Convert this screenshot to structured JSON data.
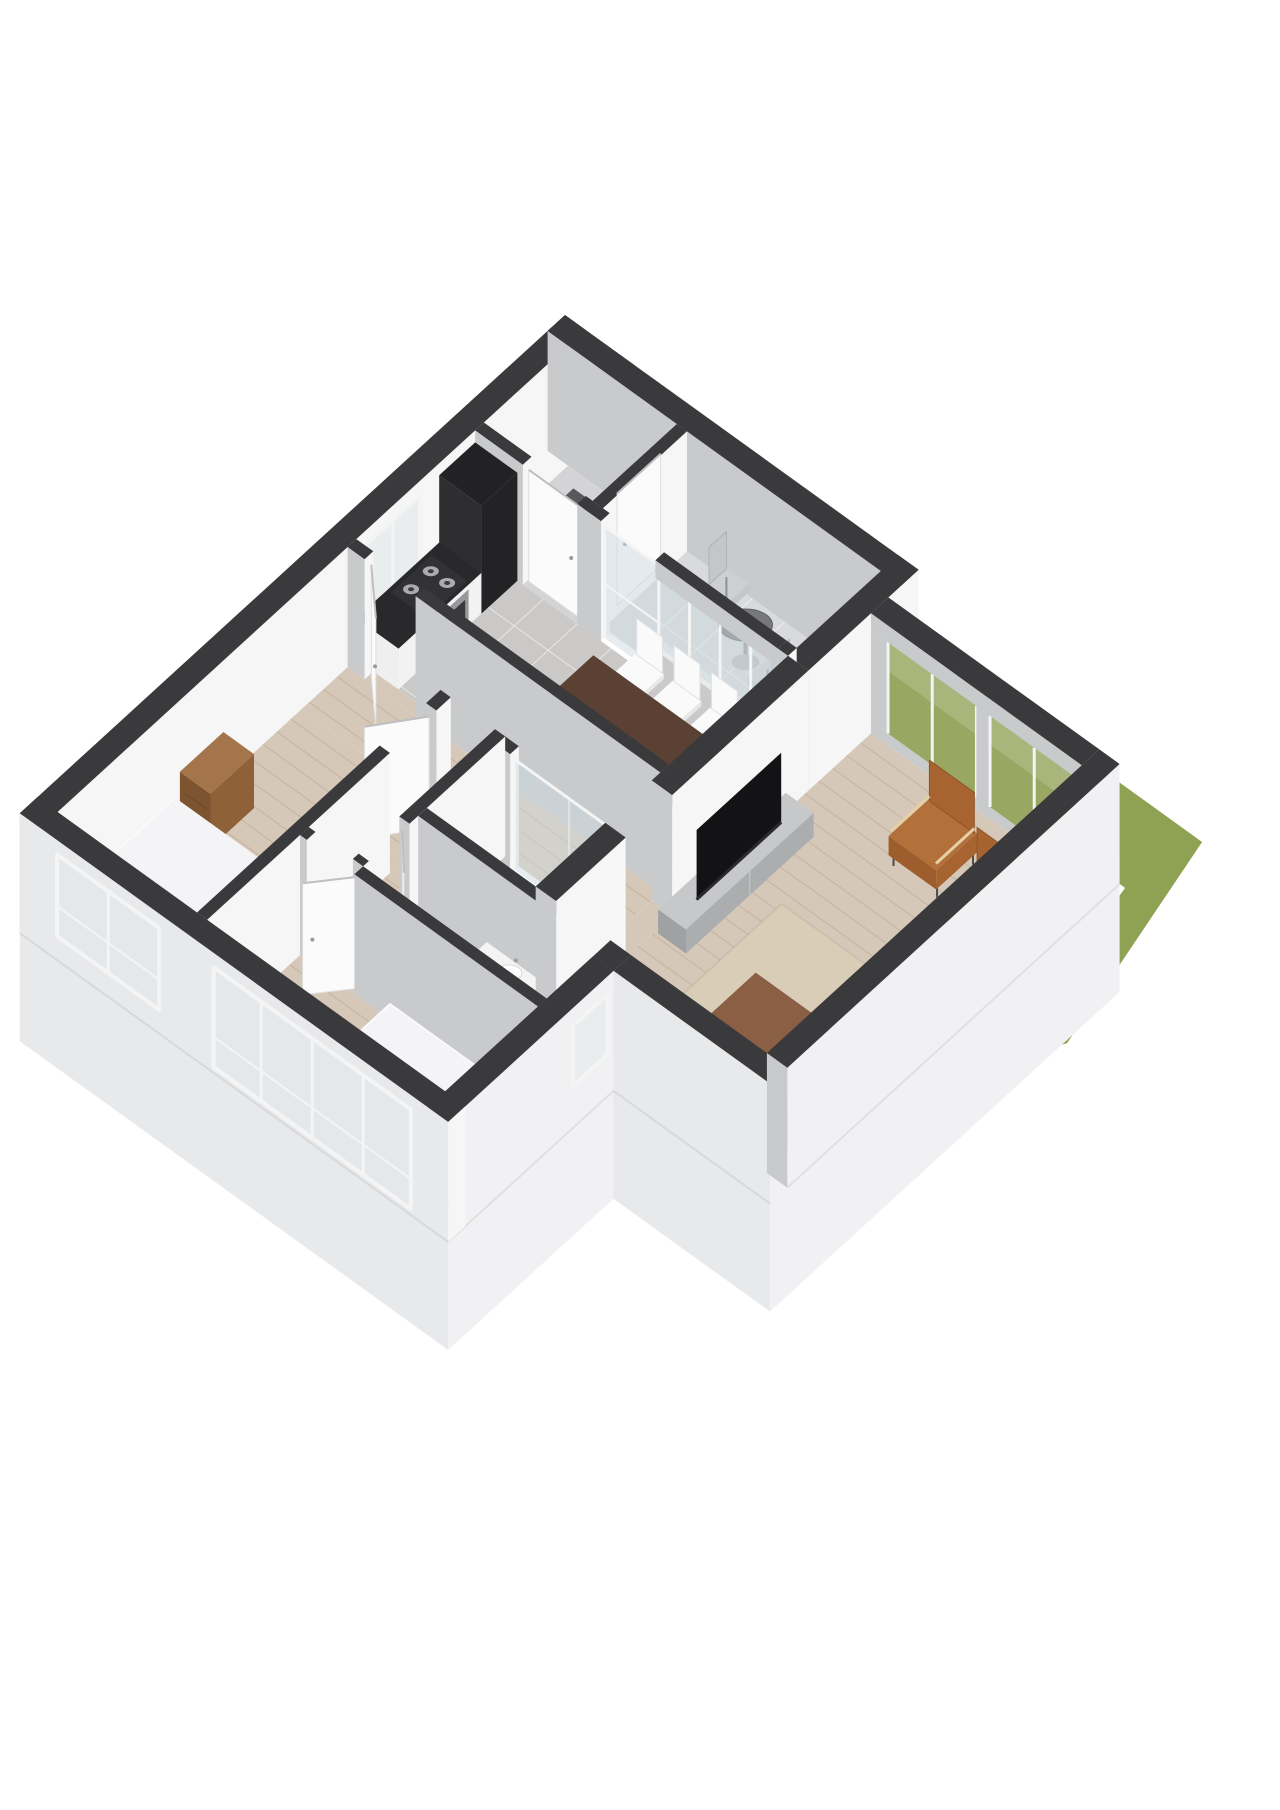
{
  "scene": {
    "label": "3D isometric floor plan render of a two-bedroom apartment with recessed balcony, living room facing a green garden, kitchen-diner, bathroom and shower room",
    "background": "#ffffff"
  },
  "palette": {
    "wallTop": "#3a3a3c",
    "faceSE": "#f6f6f7",
    "faceSW": "#c9cacc",
    "facadeSW": "#e8e9eb",
    "facadeSE": "#f1f1f3",
    "seam": "rgba(0,0,0,0.07)",
    "grass": "#8fa254",
    "grassPane": "#9aa762",
    "floorWood": "#d6c8b8",
    "plankLine": "rgba(150,125,100,0.28)",
    "floorTile": "#cbc9c7",
    "tileLine": "rgba(255,255,255,0.55)",
    "floorBath": "#c8c7c6",
    "floorBalcony": "#d9dadb",
    "floorVest": "#d4d4d6",
    "doormat": "#57585a",
    "counterDark": "#29292b",
    "tallUnit": "#242427",
    "cabinetWhite": "#f2f2f3",
    "steel": "#96989b",
    "ovenGlass": "#3a3a3d",
    "hobTop": "#323234",
    "burner": "#a9abad",
    "tableTop": "#5a4133",
    "tableSide": "#49342a",
    "chairWhite": "#fafafb",
    "chairWhiteShade": "#e8e8ea",
    "tvBlack": "#131315",
    "tvStandTop": "#c6c8ca",
    "tvStandFront": "#abadaf",
    "rug": "#dacdb8",
    "coffeeTop": "#8a5f43",
    "coffeeSide": "#774f36",
    "cognacSeat": "#b4703a",
    "cognacBack": "#a86430",
    "armWood": "#e6cfa4",
    "frameDark": "#4a4b4d",
    "sofaSeat": "#b9c6bf",
    "sofaBack": "#9faea6",
    "sofaSide": "#aab9b1",
    "sofaRail": "#cfae80",
    "bedTop": "#fafafb",
    "bedSideU": "#ececee",
    "bedSideV": "#f1f1f3",
    "pillow": "#ffffff",
    "dresserTop": "#a4744a",
    "dresserFront": "#8f6138",
    "dresserSide": "#7c5430",
    "vanityWood": "#b68a58",
    "vanityTop": "#f4f4f5",
    "toilet": "#fafafb",
    "glass": "rgba(205,218,224,0.5)",
    "glassLight": "#e9edee",
    "frameWhite": "#f4f4f5",
    "doorWhite": "#fbfbfc",
    "metalChair": "#c4c7c9",
    "metalSeat": "#cdd0d2",
    "metalLeg": "#909294",
    "balconyTable": "#76787a"
  },
  "rooms": [
    {
      "id": "vestibule",
      "name": "Entrance hall"
    },
    {
      "id": "balcony",
      "name": "Balcony"
    },
    {
      "id": "kitchen-dining",
      "name": "Kitchen / dining room"
    },
    {
      "id": "hallway",
      "name": "Hallway"
    },
    {
      "id": "living-room",
      "name": "Living room"
    },
    {
      "id": "bedroom-1",
      "name": "Bedroom 1"
    },
    {
      "id": "bedroom-2",
      "name": "Bedroom 2"
    },
    {
      "id": "shower-room",
      "name": "Shower room"
    },
    {
      "id": "bathroom",
      "name": "Bathroom"
    },
    {
      "id": "garden",
      "name": "Garden"
    }
  ],
  "furniture": [
    "kitchen-tall-unit",
    "kitchen-counter",
    "gas-hob",
    "oven",
    "dining-table",
    "dining-chair",
    "balcony-table",
    "balcony-chair",
    "tv",
    "tv-stand",
    "rug",
    "coffee-table",
    "lounge-chair",
    "sofa",
    "double-bed",
    "dresser",
    "single-bed",
    "bathroom-vanity",
    "toilet",
    "shower",
    "door",
    "window"
  ]
}
